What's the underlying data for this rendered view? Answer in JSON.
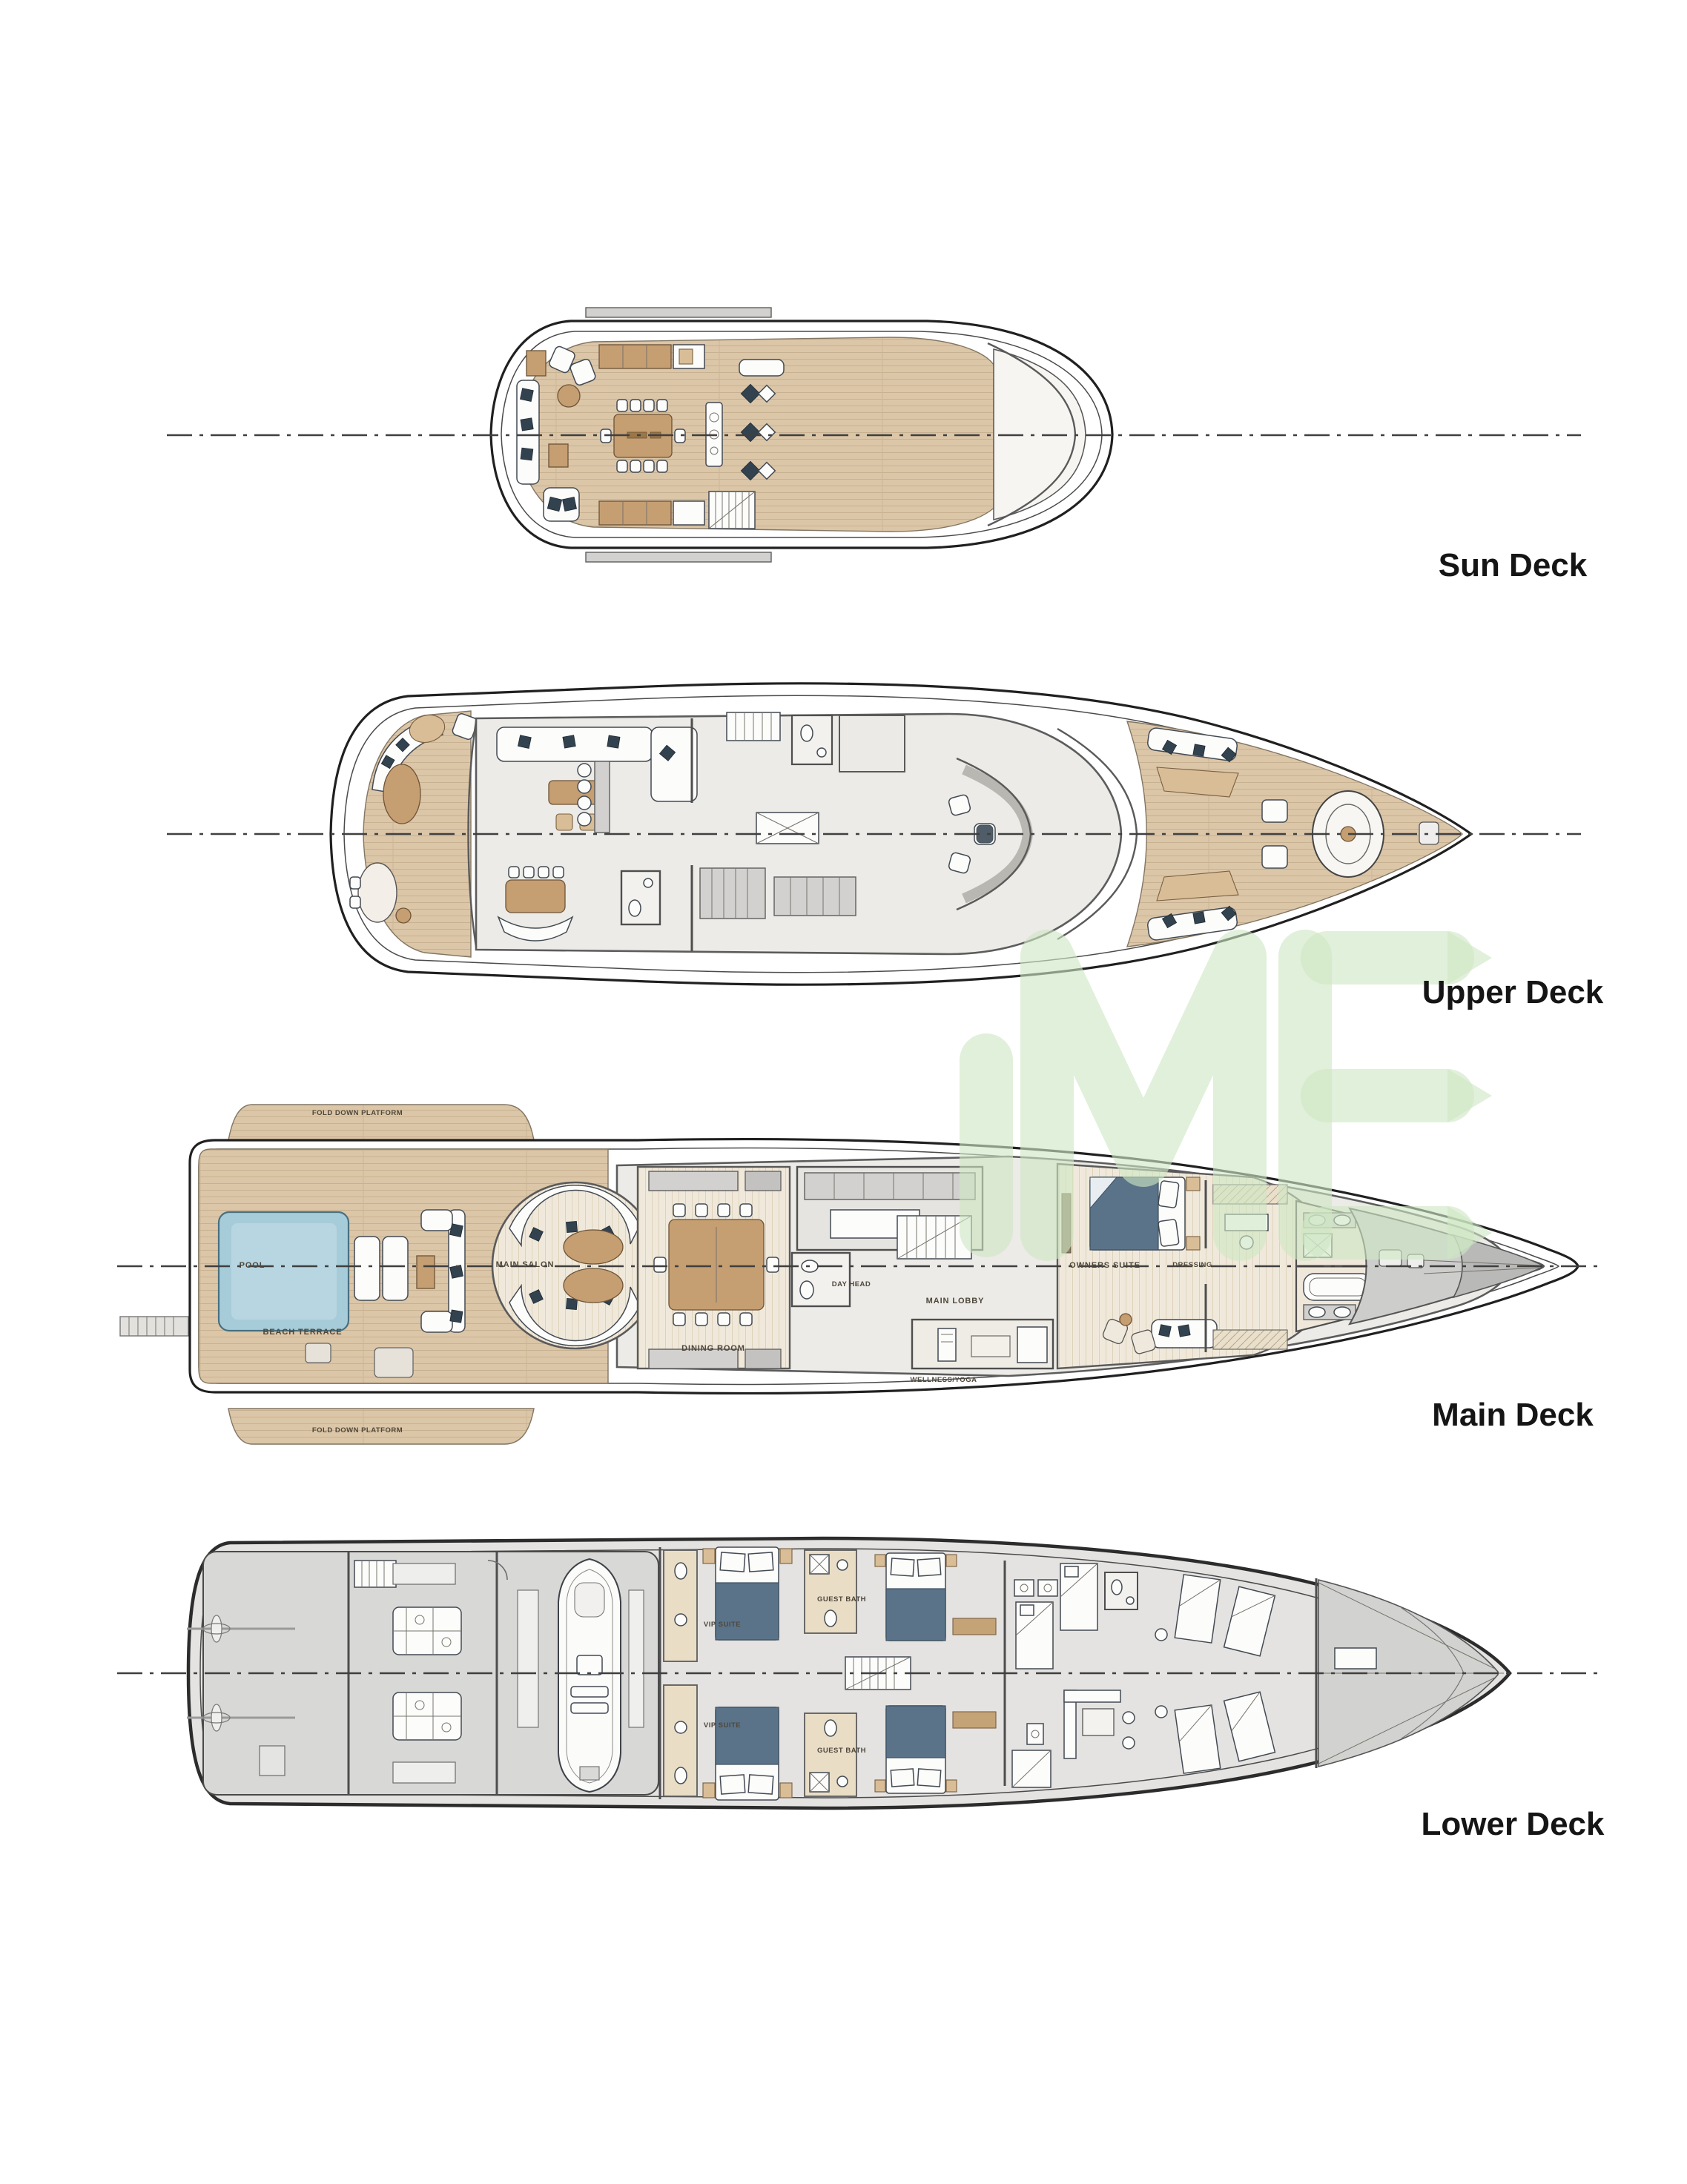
{
  "document": {
    "type": "yacht-general-arrangement",
    "background": "#ffffff"
  },
  "decks": [
    {
      "id": "sun",
      "name": "Sun Deck",
      "labels": {}
    },
    {
      "id": "upper",
      "name": "Upper Deck",
      "labels": {}
    },
    {
      "id": "main",
      "name": "Main Deck",
      "labels": {
        "fold_platform_top": "FOLD DOWN PLATFORM",
        "fold_platform_bottom": "FOLD DOWN PLATFORM",
        "pool": "POOL",
        "beach_terrace": "BEACH TERRACE",
        "main_salon": "MAIN SALON",
        "dining_room": "DINING ROOM",
        "day_head": "DAY HEAD",
        "main_lobby": "MAIN LOBBY",
        "wellness": "WELLNESS/YOGA",
        "owners_suite": "OWNERS SUITE",
        "dressing": "DRESSING"
      }
    },
    {
      "id": "lower",
      "name": "Lower Deck",
      "labels": {
        "vip_suite_top": "VIP SUITE",
        "vip_suite_bottom": "VIP SUITE",
        "guest_bath_top": "GUEST BATH",
        "guest_bath_bottom": "GUEST BATH"
      }
    }
  ],
  "watermark": {
    "text": "ME",
    "color": "#cfe7c4"
  },
  "colors": {
    "teak_deck": "#dcc6a8",
    "wood_floor": "#f0e9db",
    "pool_water": "#a6cbd9",
    "cushion_navy": "#33424f",
    "hull_outline": "#202020",
    "title_text": "#151515",
    "room_label_text": "#4e473b"
  }
}
